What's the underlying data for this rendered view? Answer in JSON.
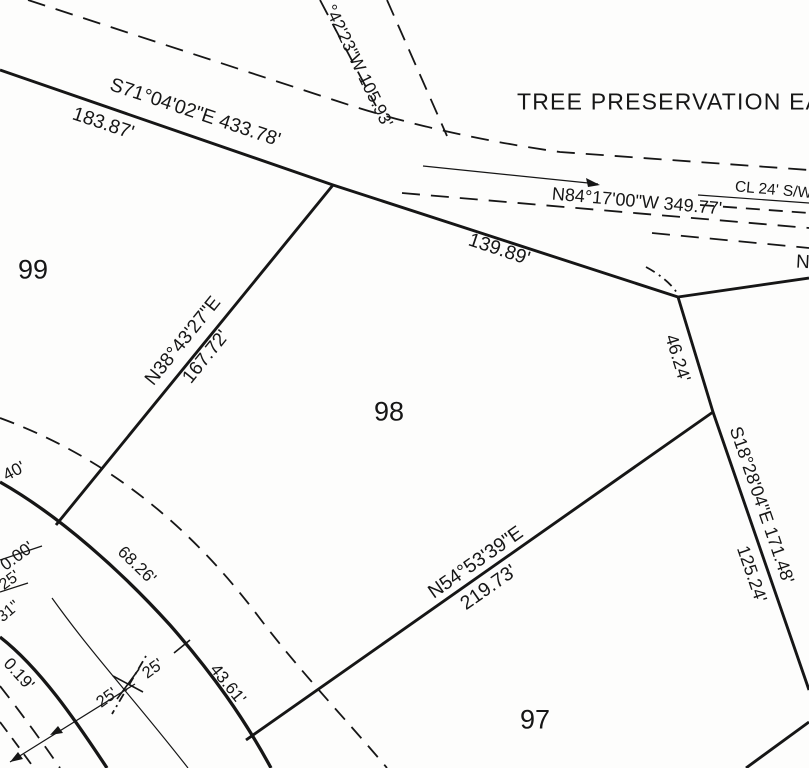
{
  "map": {
    "kind": "plat-survey-map",
    "background_color": "#fdfdfc",
    "ink_color": "#161616"
  },
  "lots": {
    "lot_99": "99",
    "lot_98": "98",
    "lot_97": "97"
  },
  "easement_title": "TREE PRESERVATION EASEMENT",
  "labels": [
    {
      "name": "bearing-s71",
      "text": "S71°04'02\"E 433.78'",
      "x": 195,
      "y": 113,
      "rot": 18.5,
      "fs": 19.5,
      "anchor": "center"
    },
    {
      "name": "distance-183-87",
      "text": "183.87'",
      "x": 103,
      "y": 124,
      "rot": 18.5,
      "fs": 19.5,
      "anchor": "center"
    },
    {
      "name": "bearing-42-23-w",
      "text": "°42'23\"W  105.93'",
      "x": 329,
      "y": 6,
      "rot": 64,
      "fs": 17.5,
      "anchor": "left"
    },
    {
      "name": "tree-preservation-easement",
      "text": "TREE PRESERVATION EASEMENT",
      "x": 517,
      "y": 102,
      "rot": 0,
      "fs": 23,
      "ls": 1.2,
      "anchor": "left"
    },
    {
      "name": "bearing-n84",
      "text": "N84°17'00\"W  349.77'",
      "x": 637,
      "y": 201,
      "rot": 5,
      "fs": 18,
      "anchor": "center"
    },
    {
      "name": "cl-24-sw",
      "text": "CL 24' S/W",
      "x": 735,
      "y": 187,
      "rot": 5,
      "fs": 15.5,
      "anchor": "left"
    },
    {
      "name": "distance-139-89",
      "text": "139.89'",
      "x": 499,
      "y": 250,
      "rot": 18.5,
      "fs": 19.5,
      "anchor": "center"
    },
    {
      "name": "lot-number-99",
      "text": "99",
      "x": 33,
      "y": 270,
      "rot": 0,
      "fs": 27,
      "anchor": "center"
    },
    {
      "name": "lot-number-98",
      "text": "98",
      "x": 389,
      "y": 412,
      "rot": 0,
      "fs": 27,
      "anchor": "center"
    },
    {
      "name": "lot-number-97",
      "text": "97",
      "x": 535,
      "y": 720,
      "rot": 0,
      "fs": 27,
      "anchor": "center"
    },
    {
      "name": "bearing-n38",
      "text": "N38°43'27\"E",
      "x": 183,
      "y": 341,
      "rot": -51,
      "fs": 19,
      "anchor": "center"
    },
    {
      "name": "distance-167-72",
      "text": "167.72'",
      "x": 206,
      "y": 357,
      "rot": -51,
      "fs": 19,
      "anchor": "center"
    },
    {
      "name": "distance-46-24",
      "text": "46.24'",
      "x": 678,
      "y": 358,
      "rot": 73,
      "fs": 18,
      "anchor": "center"
    },
    {
      "name": "bearing-s18",
      "text": "S18°28'04\"E  171.48'",
      "x": 762,
      "y": 505,
      "rot": 71,
      "fs": 18,
      "anchor": "center"
    },
    {
      "name": "distance-125-24",
      "text": "125.24'",
      "x": 752,
      "y": 574,
      "rot": 71,
      "fs": 18,
      "anchor": "center"
    },
    {
      "name": "bearing-n54",
      "text": "N54°53'39\"E",
      "x": 476,
      "y": 563,
      "rot": -35,
      "fs": 19.5,
      "anchor": "center"
    },
    {
      "name": "distance-219-73",
      "text": "219.73'",
      "x": 489,
      "y": 588,
      "rot": -35,
      "fs": 19.5,
      "anchor": "center"
    },
    {
      "name": "distance-68-26",
      "text": "68.26'",
      "x": 137,
      "y": 565,
      "rot": 44,
      "fs": 17,
      "anchor": "center"
    },
    {
      "name": "distance-43-61",
      "text": "43.61'",
      "x": 228,
      "y": 684,
      "rot": 51,
      "fs": 17,
      "anchor": "center"
    },
    {
      "name": "distance-40",
      "text": "40'",
      "x": 14,
      "y": 471,
      "rot": -28,
      "fs": 17,
      "anchor": "center"
    },
    {
      "name": "distance-0-00",
      "text": "0.00'",
      "x": 17,
      "y": 556,
      "rot": -36,
      "fs": 17,
      "anchor": "center"
    },
    {
      "name": "distance-25-edge",
      "text": "25'",
      "x": 10,
      "y": 581,
      "rot": -36,
      "fs": 16,
      "anchor": "center"
    },
    {
      "name": "seconds-31",
      "text": "31\"",
      "x": 9,
      "y": 612,
      "rot": -40,
      "fs": 16,
      "anchor": "center"
    },
    {
      "name": "distance-0-19",
      "text": "0.19'",
      "x": 19,
      "y": 674,
      "rot": 48,
      "fs": 17,
      "anchor": "center"
    },
    {
      "name": "halfwidth-25-left",
      "text": "25'",
      "x": 107,
      "y": 698,
      "rot": -36,
      "fs": 16.5,
      "anchor": "center"
    },
    {
      "name": "halfwidth-25-right",
      "text": "25'",
      "x": 153,
      "y": 669,
      "rot": -36,
      "fs": 16.5,
      "anchor": "center"
    },
    {
      "name": "bearing-fragment-n",
      "text": "N",
      "x": 796,
      "y": 262,
      "rot": 3,
      "fs": 19,
      "anchor": "left"
    }
  ]
}
